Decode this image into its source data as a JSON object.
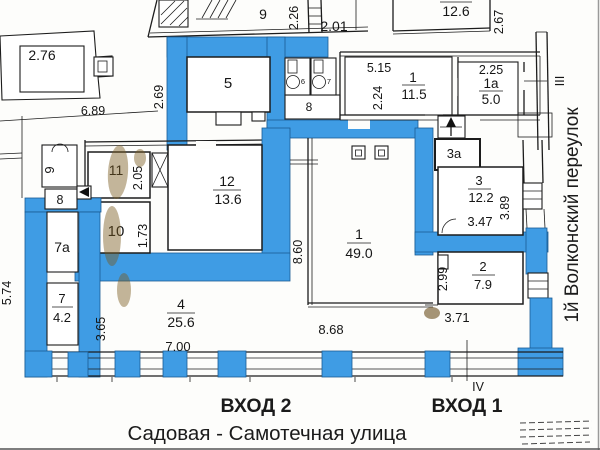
{
  "colors": {
    "highlight_blue": "#3f9ce4",
    "line_black": "#1c1c1c",
    "stain_brown": "#7a5a1e"
  },
  "streets": {
    "bottom": "Садовая - Самотечная улица",
    "right": "1й  Волконский переулок"
  },
  "entrances": {
    "e2": "ВХОД 2",
    "e1": "ВХОД 1"
  },
  "marks": {
    "m3": "III",
    "m4": "IV"
  },
  "rooms": {
    "big1": {
      "num": "1",
      "area": "49.0"
    },
    "small1": {
      "num": "1",
      "area": "11.5"
    },
    "r1a": {
      "num": "1a",
      "area": "5.0"
    },
    "r2": {
      "num": "2",
      "area": "7.9"
    },
    "r3": {
      "num": "3",
      "area": "12.2"
    },
    "r3a": {
      "num": "3a"
    },
    "r4": {
      "num": "4",
      "area": "25.6"
    },
    "r5": {
      "num": "5"
    },
    "wc6": {
      "num": "6"
    },
    "wc7": {
      "num": "7"
    },
    "wc8": {
      "num": "8"
    },
    "r7": {
      "num": "7",
      "area": "4.2"
    },
    "r7a": {
      "num": "7a"
    },
    "r8": {
      "num": "8"
    },
    "r9left": {
      "num": "9"
    },
    "r9top": {
      "num": "9"
    },
    "r10": {
      "num": "10"
    },
    "r11": {
      "num": "11"
    },
    "r12": {
      "num": "12",
      "area": "13.6"
    },
    "r126": {
      "area": "12.6"
    },
    "r276": {
      "area": "2.76"
    }
  },
  "dims": {
    "d689": "6.89",
    "d269": "2.69",
    "d226": "2.26",
    "d201": "2.01",
    "d267": "2.67",
    "d515": "5.15",
    "d224": "2.24",
    "d225": "2.25",
    "d205": "2.05",
    "d173": "1.73",
    "d347": "3.47",
    "d389": "3.89",
    "d299": "2.99",
    "d371": "3.71",
    "d860": "8.60",
    "d868": "8.68",
    "d574": "5.74",
    "d365": "3.65",
    "d700": "7.00"
  }
}
